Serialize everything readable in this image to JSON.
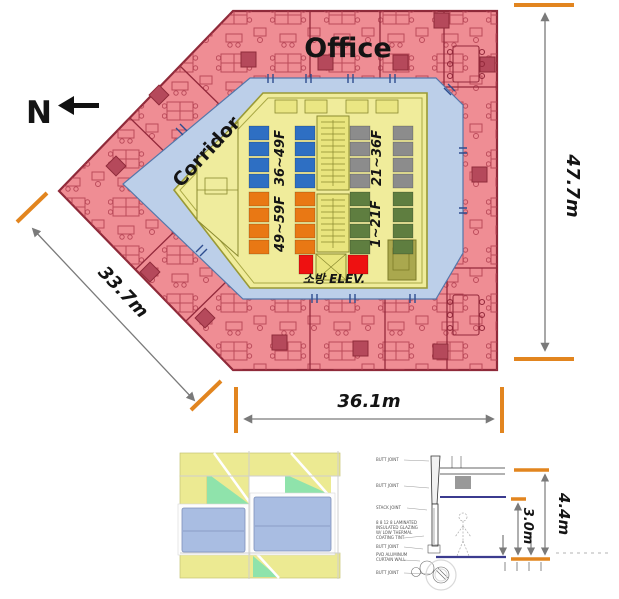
{
  "plan": {
    "north_label": "N",
    "office_label": "Office",
    "corridor_label": "Corridor",
    "fire_elevator_label": "소방 ELEV.",
    "fire_elevator_color": "#ee1111",
    "banks": [
      {
        "name": "upper-left-bank",
        "label": "36~49F",
        "color": "#2e6fc3"
      },
      {
        "name": "upper-right-bank",
        "label": "21~36F",
        "color": "#8c8c8c"
      },
      {
        "name": "lower-left-bank",
        "label": "49~59F",
        "color": "#e97814"
      },
      {
        "name": "lower-right-bank",
        "label": "1~21F",
        "color": "#5f7e40"
      }
    ],
    "colors": {
      "office": "#ef8d94",
      "corridor": "#bccfe9",
      "core": "#f0ec9b"
    }
  },
  "dimensions": {
    "right_height": "47.7m",
    "bottom_width": "36.1m",
    "diagonal_width": "33.7m",
    "tick_color": "#e2851f"
  },
  "detail": {
    "floor_height": "4.4m",
    "vision_height": "3.0m",
    "callouts": [
      "BUTT JOINT",
      "BUTT JOINT",
      "STACK JOINT",
      "8 8 12 8 LAMINATED",
      "INSULATED GLAZING",
      "W/ LOW THERMAL",
      "COATING TINT",
      "BUTT JOINT",
      "PVD ALUMINUM",
      "CURTAIN WALL",
      "BUTT JOINT"
    ]
  }
}
